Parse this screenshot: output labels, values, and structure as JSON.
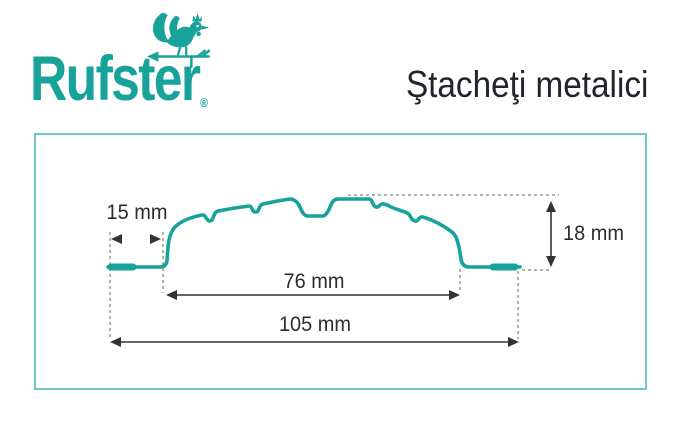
{
  "brand": {
    "logo_text": "Rufster",
    "registered_mark": "®",
    "logo_color": "#17a29a",
    "icon": "rooster-weathervane-icon"
  },
  "header": {
    "title": "Ştacheţi metalici"
  },
  "diagram": {
    "type": "metal-picket-profile-cross-section",
    "profile_color": "#17a29a",
    "panel_border_color": "#6cc9c3",
    "dimension_line_color": "#333333",
    "dashed_guide_color": "#666666",
    "dimensions": [
      {
        "id": "side-wing-width",
        "label": "15 mm"
      },
      {
        "id": "body-width",
        "label": "76 mm"
      },
      {
        "id": "total-width",
        "label": "105 mm"
      },
      {
        "id": "profile-height",
        "label": "18 mm"
      }
    ]
  }
}
